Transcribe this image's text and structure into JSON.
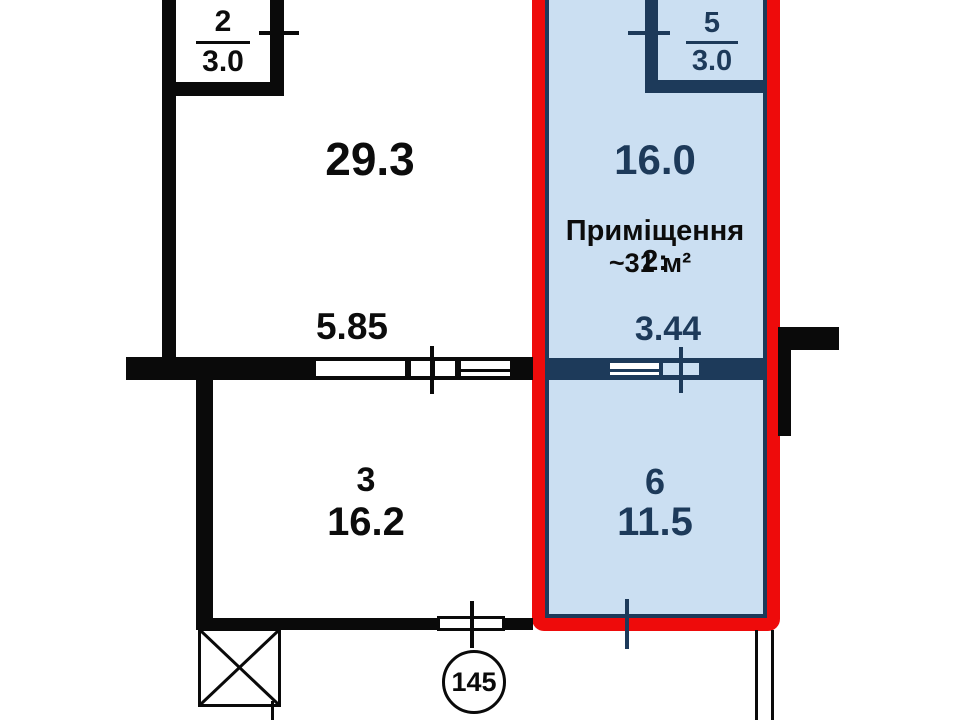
{
  "plan_title": "apartment-floor-plan",
  "rooms": {
    "r2": {
      "id": "2",
      "area": "3.0"
    },
    "r_main": {
      "area": "29.3"
    },
    "r3": {
      "id": "3",
      "area": "16.2"
    },
    "r5": {
      "id": "5",
      "area": "3.0"
    },
    "r16": {
      "area": "16.0"
    },
    "r6": {
      "id": "6",
      "area": "11.5"
    }
  },
  "highlight": {
    "title": "Приміщення 2:",
    "area_note": "~31 м²",
    "border_color": "#ee0b0b",
    "fill_color": "#cbdff2",
    "wall_color": "#1d3a5a"
  },
  "dimensions": {
    "d1": "5.85",
    "d2": "3.44"
  },
  "unit_number": "145",
  "colors": {
    "wall": "#0a0a0a",
    "background": "#ffffff"
  }
}
